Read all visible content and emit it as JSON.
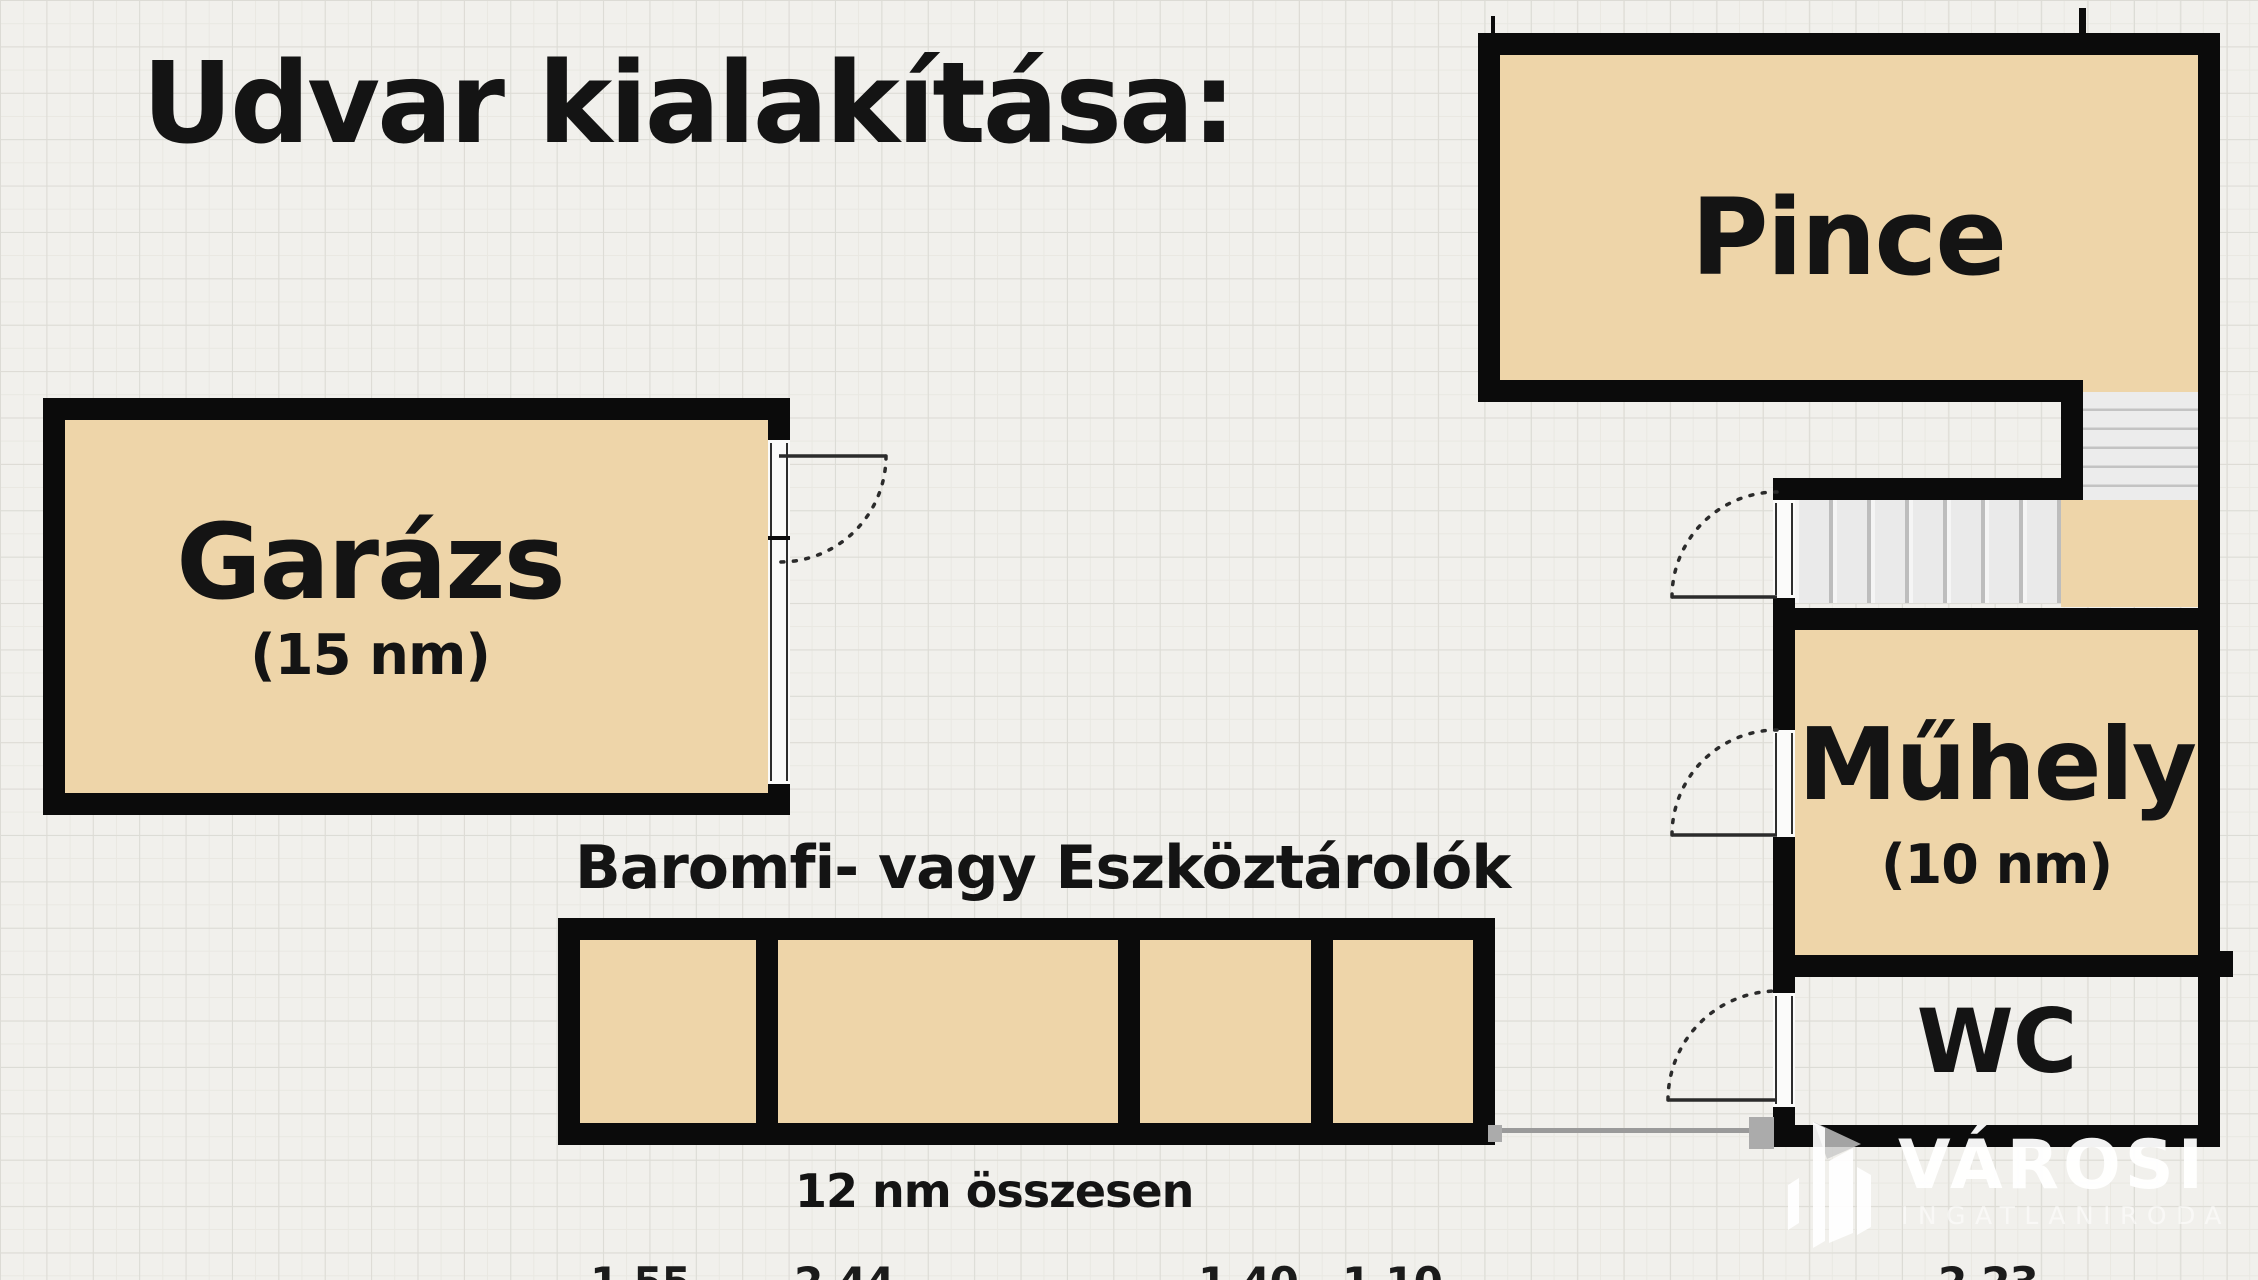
{
  "title": "Udvar kialakítása:",
  "rooms": {
    "garage": {
      "name": "Garázs",
      "size": "(15 nm)"
    },
    "cellar": {
      "name": "Pince"
    },
    "workshop": {
      "name": "Műhely",
      "size": "(10 nm)"
    },
    "wc": {
      "name": "WC"
    }
  },
  "storage": {
    "label": "Baromfi- vagy Eszköztárolók",
    "total": "12 nm összesen",
    "cell_count": 4
  },
  "dimensions": {
    "d1": "1.55",
    "d2": "2.44",
    "d3": "1.40",
    "d4": "1.10",
    "d5": "2.23"
  },
  "logo": {
    "brand": "VÁROSI",
    "subtitle": "INGATLANIRODA"
  },
  "colors": {
    "wall": "#0b0b0b",
    "room_fill": "#eed5a9",
    "background": "#f1f0ec",
    "grid_major": "#dcdbd5",
    "grid_minor": "#e9e8e2",
    "stair_fill": "#ececec",
    "fence": "#9a9a9a",
    "logo_white": "#ffffff"
  }
}
